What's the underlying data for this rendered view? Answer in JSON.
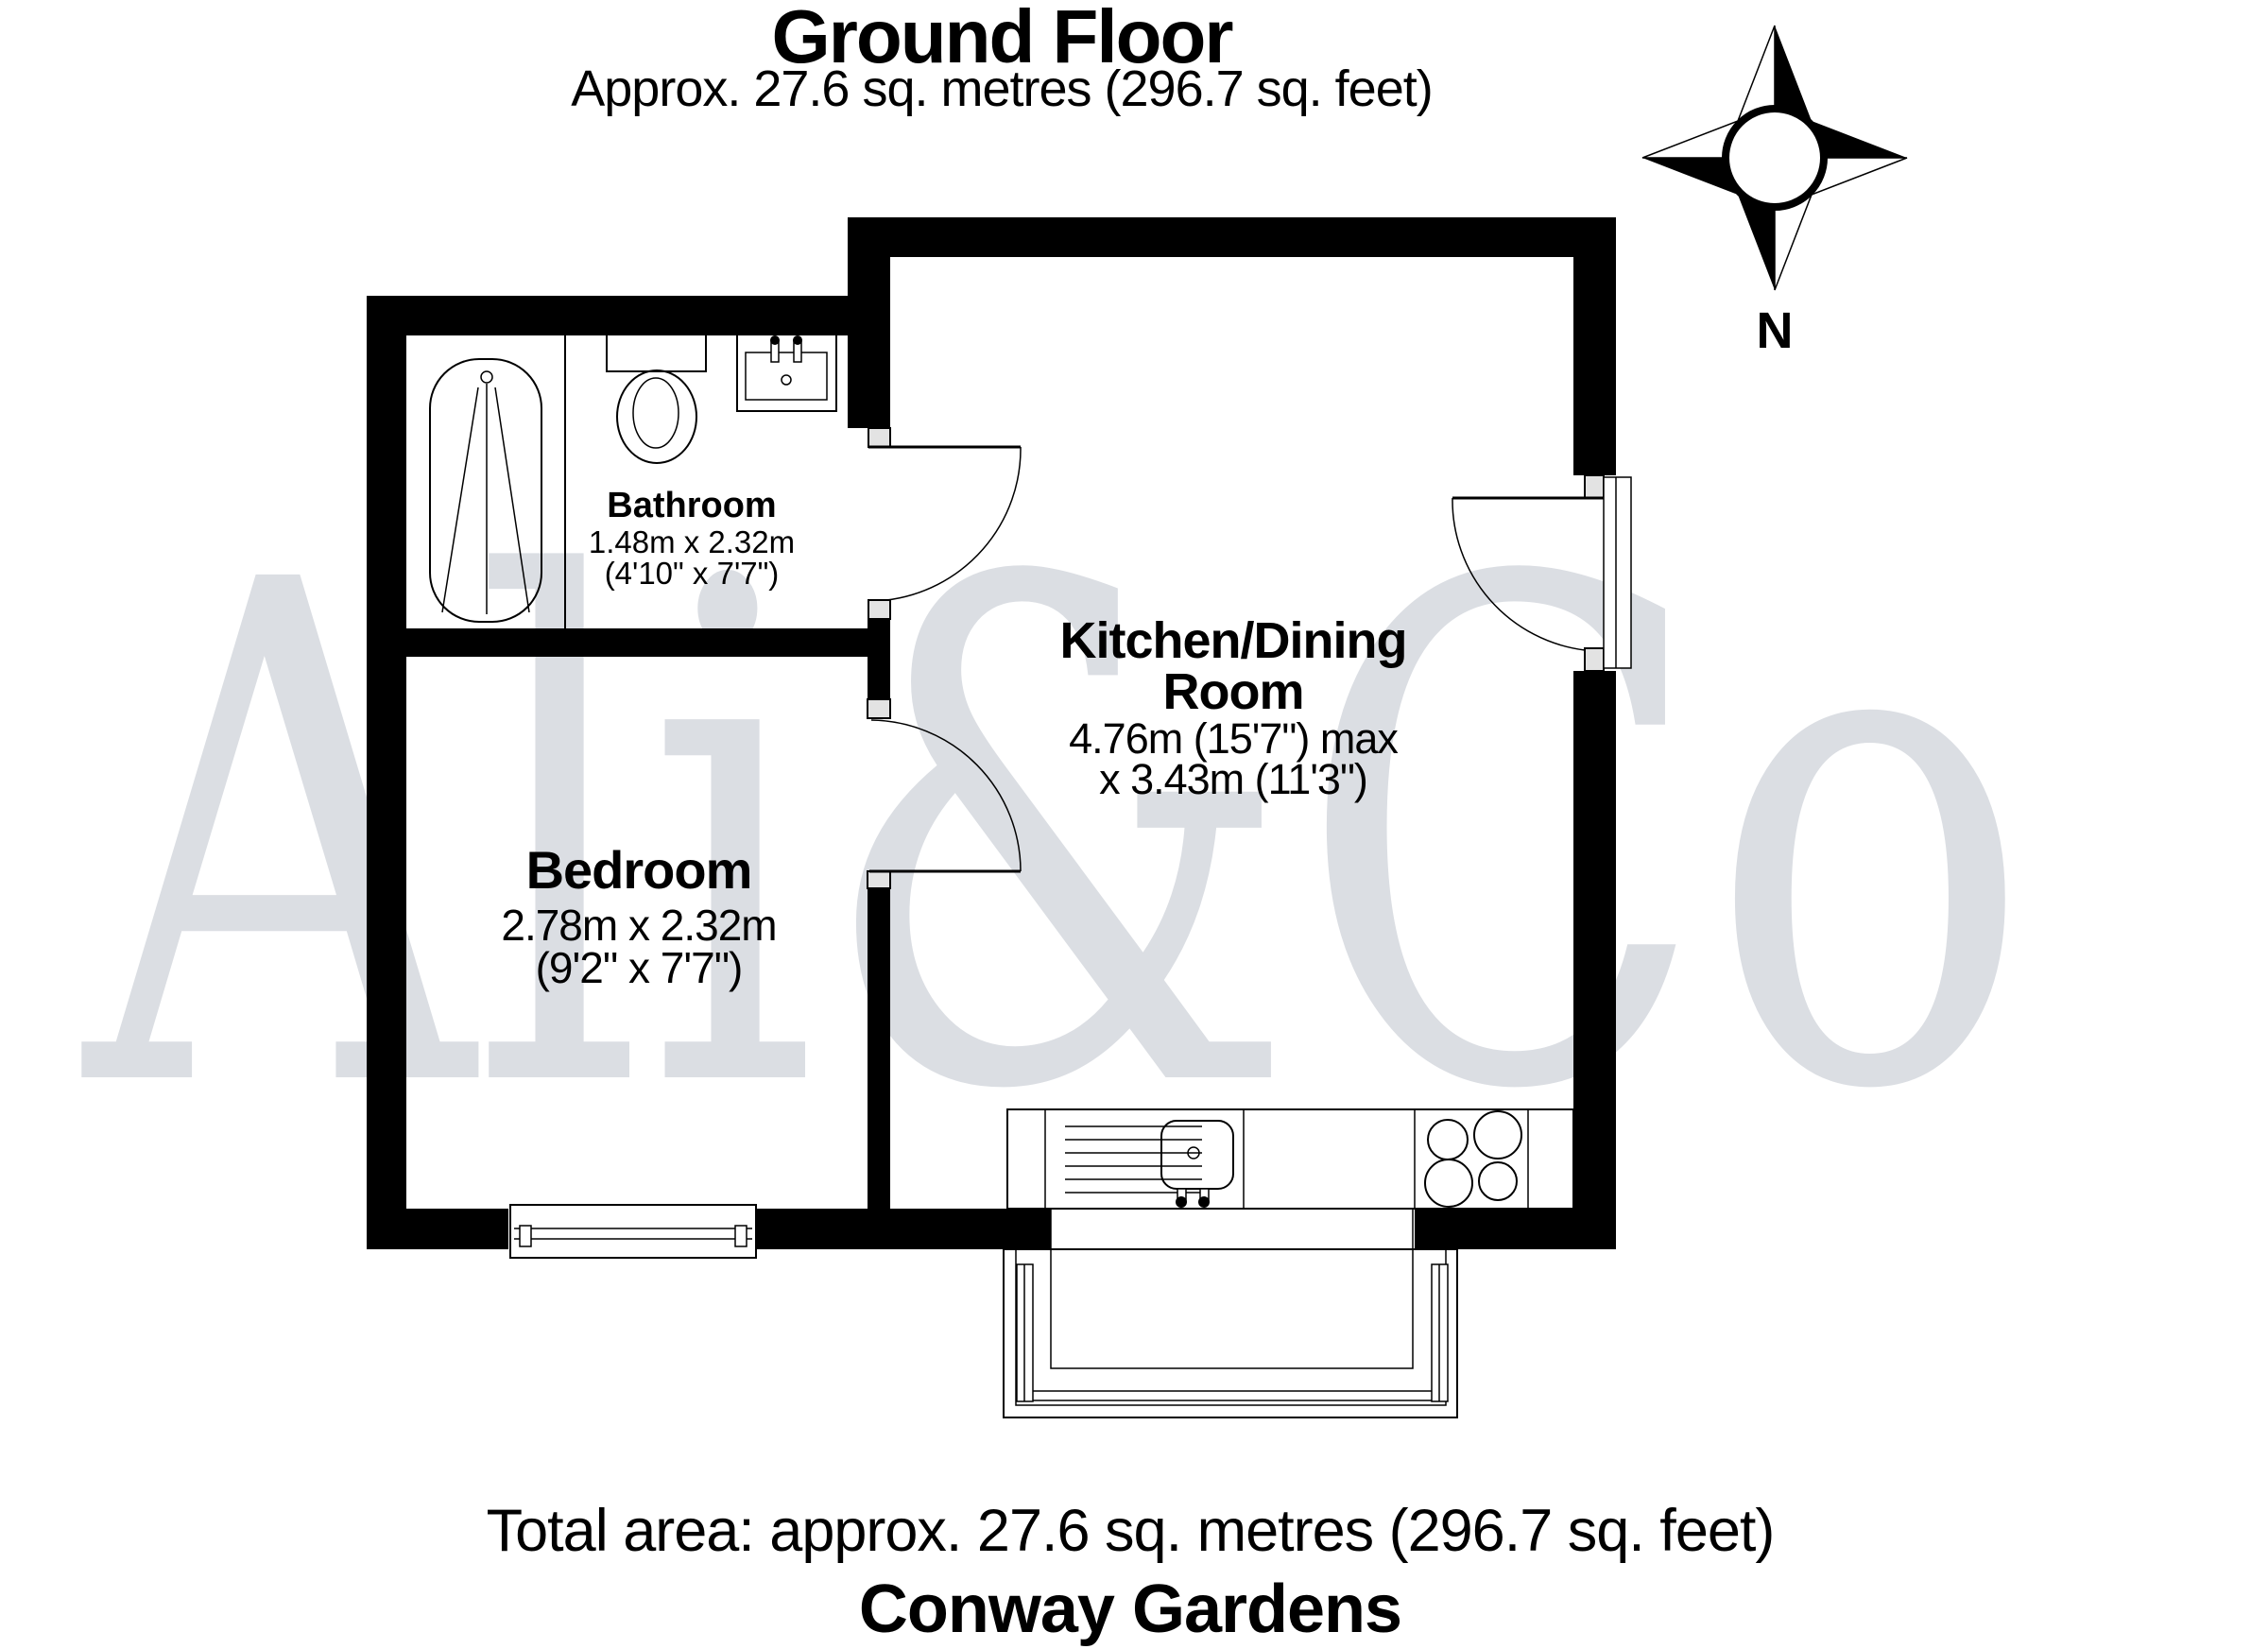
{
  "header": {
    "title": "Ground Floor",
    "subtitle": "Approx. 27.6 sq. metres (296.7 sq. feet)"
  },
  "compass": {
    "north_label": "N"
  },
  "watermark": {
    "text": "Ali&Co",
    "color": "#dbdee3"
  },
  "rooms": {
    "bathroom": {
      "name": "Bathroom",
      "dims_metric": "1.48m x 2.32m",
      "dims_imperial": "(4'10\" x 7'7\")"
    },
    "bedroom": {
      "name": "Bedroom",
      "dims_metric": "2.78m x 2.32m",
      "dims_imperial": "(9'2\" x 7'7\")"
    },
    "kitchen": {
      "name_line1": "Kitchen/Dining",
      "name_line2": "Room",
      "dims_line1": "4.76m (15'7\") max",
      "dims_line2": "x 3.43m (11'3\")"
    }
  },
  "footer": {
    "total_area": "Total area: approx. 27.6 sq. metres (296.7 sq. feet)",
    "property_name": "Conway Gardens"
  }
}
